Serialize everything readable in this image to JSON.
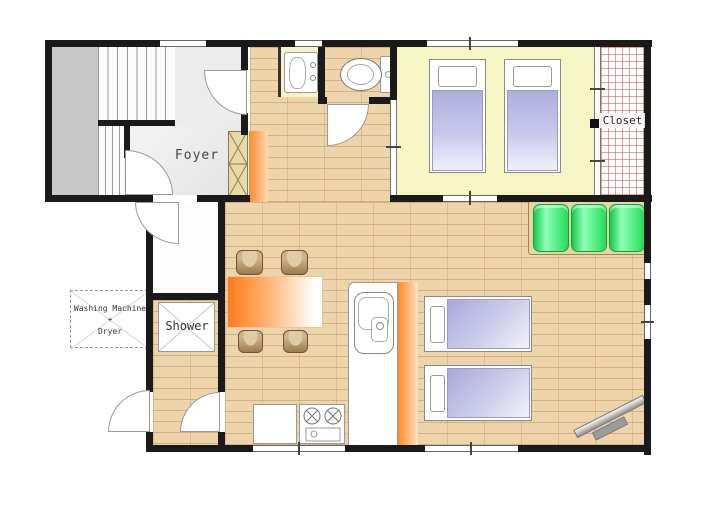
{
  "plan": {
    "type": "apartment-floor-plan",
    "labels": {
      "foyer": "Foyer",
      "shower": "Shower",
      "closet": "Closet",
      "laundry_line1": "Washing Machine",
      "laundry_line2": "+",
      "laundry_line3": "Dryer"
    },
    "colors": {
      "wall": "#1a1a1a",
      "wood_floor": "#eed4aa",
      "bedroom_floor": "#f7f4c6",
      "closet_hatch_red": "#d65046",
      "accent_orange": "#ff8a2e",
      "sofa_green": "#22dd55",
      "bed_lavender": "#aeaedd",
      "stool_brown": "#9d7b52",
      "stair_gray": "#c8c8c8"
    },
    "furniture": {
      "single_beds": 4,
      "sofa_cushions": 3,
      "dining_stools": 4,
      "dining_tables": 1,
      "stove_burners": 2,
      "toilets": 1,
      "washbasins": 1,
      "kitchen_sinks": 1,
      "tvs": 1
    }
  }
}
